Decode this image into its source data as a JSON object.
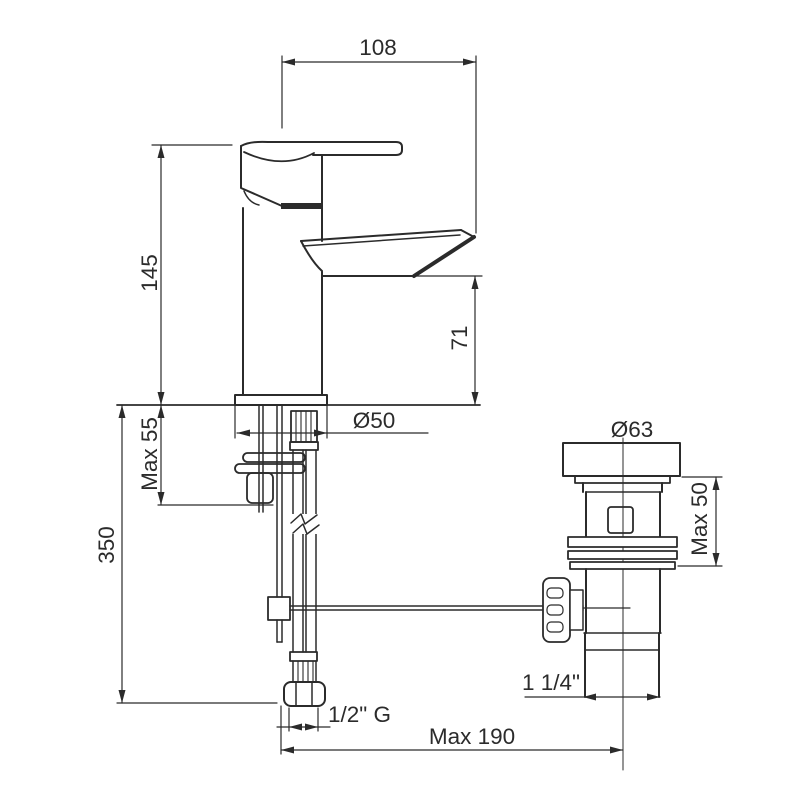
{
  "drawing": {
    "subject": "Single-lever basin mixer tap with pop-up waste drain — installation dimension diagram, front elevation",
    "units": "mm",
    "background_color": "#ffffff",
    "line_color": "#2b2b2b"
  },
  "dimensions": {
    "spout_reach": "108",
    "tap_height": "145",
    "spout_outlet_height": "71",
    "base_diameter": "Ø50",
    "max_counter_thickness": "Max 55",
    "supply_hose_length": "350",
    "waste_flange_diameter": "Ø63",
    "waste_max_counter_thickness": "Max 50",
    "waste_tail_thread": "1 1/4\"",
    "supply_thread": "1/2\" G",
    "max_popup_rod_reach": "Max 190"
  }
}
